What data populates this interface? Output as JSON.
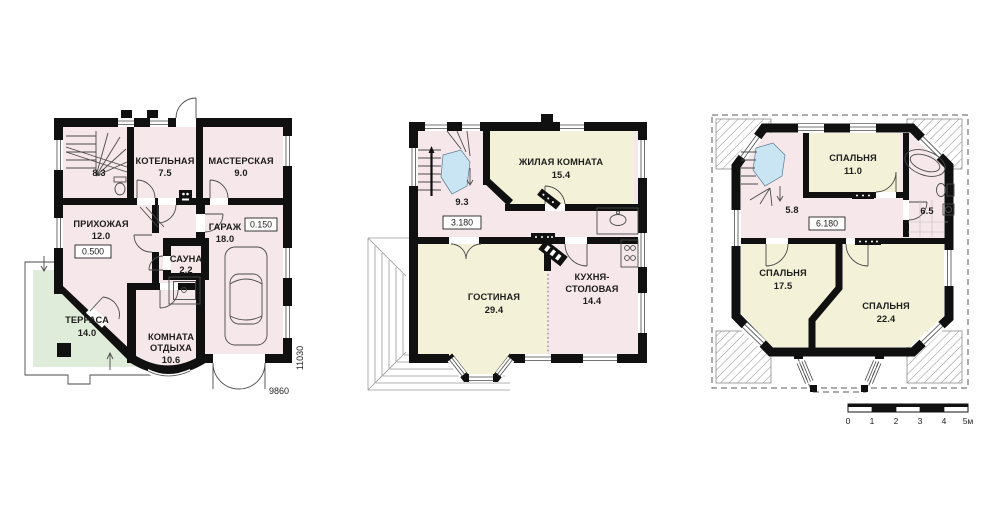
{
  "palette": {
    "wall": "#101010",
    "room-pink": "#f6e7ea",
    "room-cream": "#f4f1d9",
    "terrace-green": "#dfecd9",
    "stair-blue": "#c9e5f4",
    "paper": "#ffffff",
    "ink": "#1d1d1b"
  },
  "plans": {
    "ground": {
      "rooms": {
        "stairs": {
          "area": "8.3"
        },
        "boiler": {
          "label": "КОТЕЛЬНАЯ",
          "area": "7.5"
        },
        "workshop": {
          "label": "МАСТЕРСКАЯ",
          "area": "9.0"
        },
        "hallway": {
          "label": "ПРИХОЖАЯ",
          "area": "12.0",
          "level": "0.500"
        },
        "garage": {
          "label": "ГАРАЖ",
          "area": "18.0",
          "level": "0.150"
        },
        "sauna": {
          "label": "САУНА",
          "area": "2.2"
        },
        "lounge": {
          "label_line1": "КОМНАТА",
          "label_line2": "ОТДЫХА",
          "area": "10.6"
        },
        "terrace": {
          "label": "ТЕРРАСА",
          "area": "14.0"
        }
      },
      "dimensions": {
        "width_mm": "9860",
        "height_mm": "11030"
      }
    },
    "first": {
      "rooms": {
        "stairs": {
          "area": "9.3",
          "level": "3.180"
        },
        "living_room": {
          "label": "ЖИЛАЯ КОМНАТА",
          "area": "15.4"
        },
        "lounge": {
          "label": "ГОСТИНАЯ",
          "area": "29.4"
        },
        "kitchen_dining": {
          "label_line1": "КУХНЯ-",
          "label_line2": "СТОЛОВАЯ",
          "area": "14.4"
        }
      }
    },
    "second": {
      "rooms": {
        "hall": {
          "area": "5.8",
          "level": "6.180"
        },
        "bedroom_small": {
          "label": "СПАЛЬНЯ",
          "area": "11.0"
        },
        "bathroom": {
          "area": "6.5"
        },
        "bedroom_mid": {
          "label": "СПАЛЬНЯ",
          "area": "17.5"
        },
        "bedroom_large": {
          "label": "СПАЛЬНЯ",
          "area": "22.4"
        }
      }
    }
  },
  "scale_bar": {
    "unit_labels": [
      "0",
      "1",
      "2",
      "3",
      "4",
      "5м"
    ]
  }
}
